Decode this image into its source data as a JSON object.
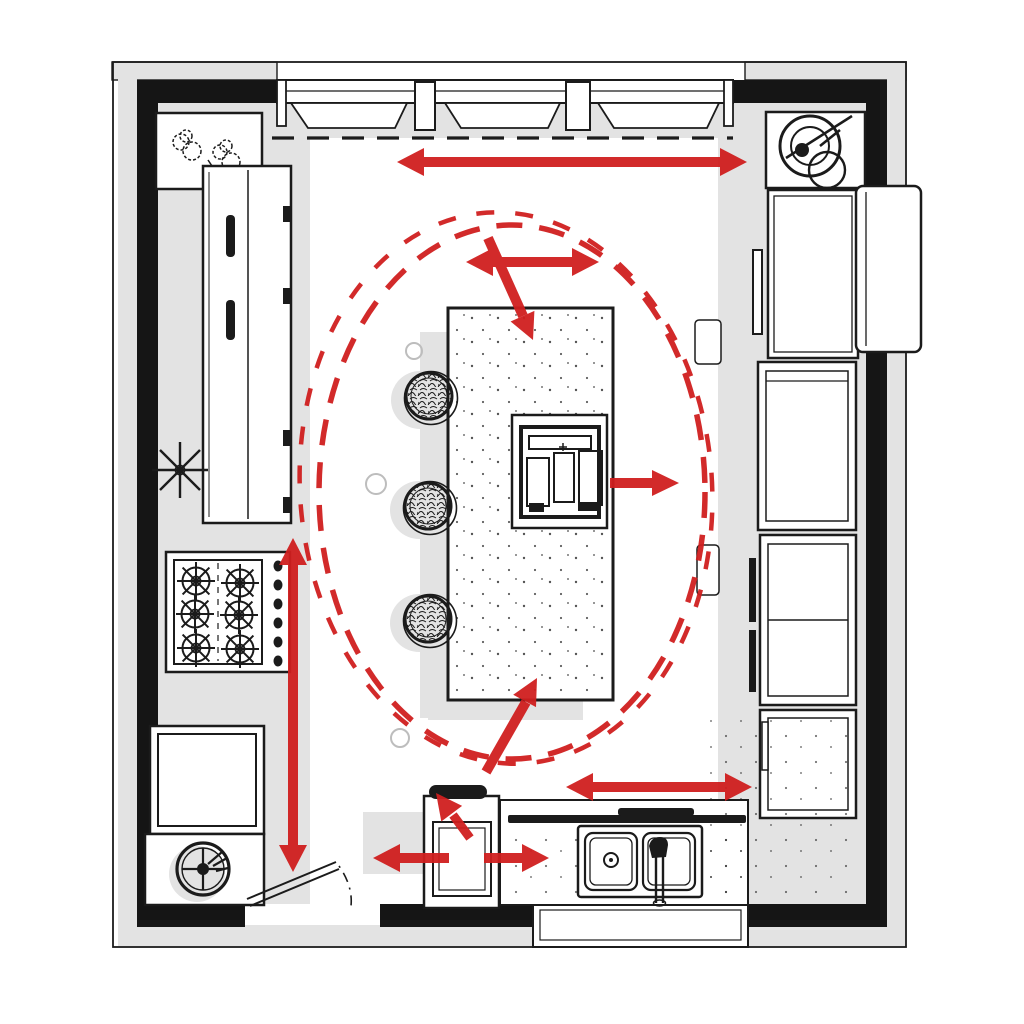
{
  "meta": {
    "description": "Hand-sketched kitchen floor plan with red work-zone circulation overlay",
    "drawing_type": "kitchen plan diagram",
    "text_labels": []
  },
  "colors": {
    "accent": "#d01f1f",
    "ink": "#1b1b1b",
    "wall": "#151515",
    "shadow": "#e3e3e3",
    "paper": "#ffffff"
  },
  "components": {
    "perimeter": {
      "top": "window run with three windows and dashed upper-cabinet line",
      "bottom_left": "door opening with swing leaf",
      "bottom_center": "window bay behind sink",
      "walls": "thick black wall fill with gray outer shadow band"
    },
    "left_run": [
      "corner shelf with plant",
      "tall pantry cabinet with handles",
      "six-burner range with knob strip",
      "drawer base cabinet",
      "corner cabinet with turntable wheel"
    ],
    "island": {
      "countertop": "speckled stone island",
      "fixture": "built-in grill cooktop",
      "seating": [
        "stool",
        "stool",
        "stool"
      ]
    },
    "right_run": [
      "countertop stand-mixer in corner",
      "refrigerator with door protruding past wall",
      "double wall oven",
      "tall storage unit with pulls",
      "base cabinet"
    ],
    "bottom_run": [
      "prep cabinet with black fitting",
      "double-basin sink with faucet"
    ],
    "overlay": {
      "circulation_loop": "double dashed ellipse around island",
      "arrows": [
        "top-aisle double arrow",
        "island-top double arrow",
        "diagonal arrow into island top",
        "arrow from grill to right aisle",
        "diagonal arrow into island bottom",
        "left-aisle vertical double arrow",
        "bottom-right aisle double arrow",
        "prep arrow left",
        "prep arrow right",
        "prep arrow up"
      ]
    }
  }
}
